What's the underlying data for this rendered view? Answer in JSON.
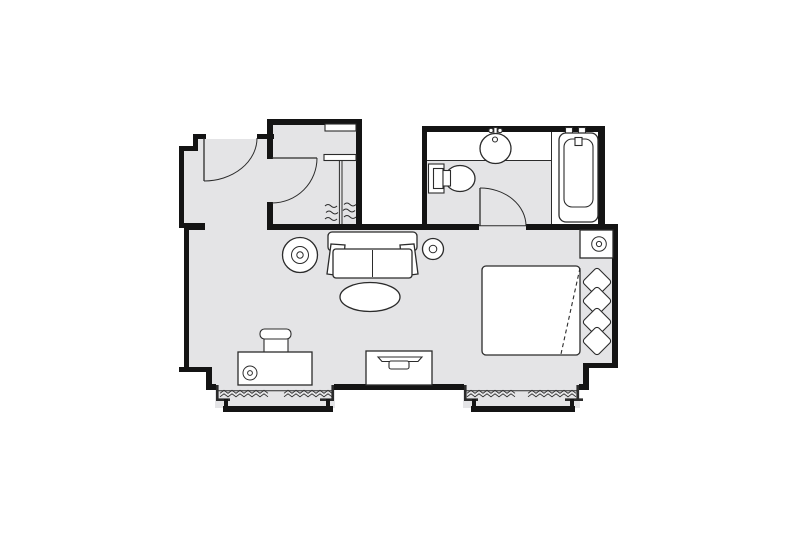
{
  "colors": {
    "background": "#ffffff",
    "floor": "#e4e4e6",
    "wall": "#141414",
    "line": "#2b2b2b",
    "white": "#ffffff"
  },
  "plan": {
    "label": "hotel guest room floor plan",
    "rooms": {
      "entry": "entry hall",
      "closet": "closet",
      "bathroom": "bathroom",
      "main": "bedroom and sitting area"
    },
    "fixtures": {
      "entry_door": "entry door with swing arc",
      "closet_door": "closet door with swing arc",
      "closet_shelf": "closet shelves",
      "closet_rod": "closet hanging rod with clothes hangers",
      "bathroom_door": "bathroom door with swing arc",
      "vanity": "vanity counter",
      "sink": "bathroom sink with faucet",
      "toilet": "toilet",
      "bathtub": "bathtub with faucet",
      "sofa": "two-seat sofa",
      "coffee_table": "oval coffee table",
      "floor_lamp": "floor lamp",
      "side_lamp": "side table lamp",
      "bed": "double bed with turned-down sheet",
      "pillows": "four pillows at headboard",
      "nightstand": "nightstand with lamp",
      "desk": "writing desk with lamp",
      "desk_chair": "desk chair",
      "tv_cabinet": "tv cabinet",
      "tv": "television",
      "window_left": "left bay window with radiator",
      "window_right": "right bay window with radiator"
    }
  }
}
